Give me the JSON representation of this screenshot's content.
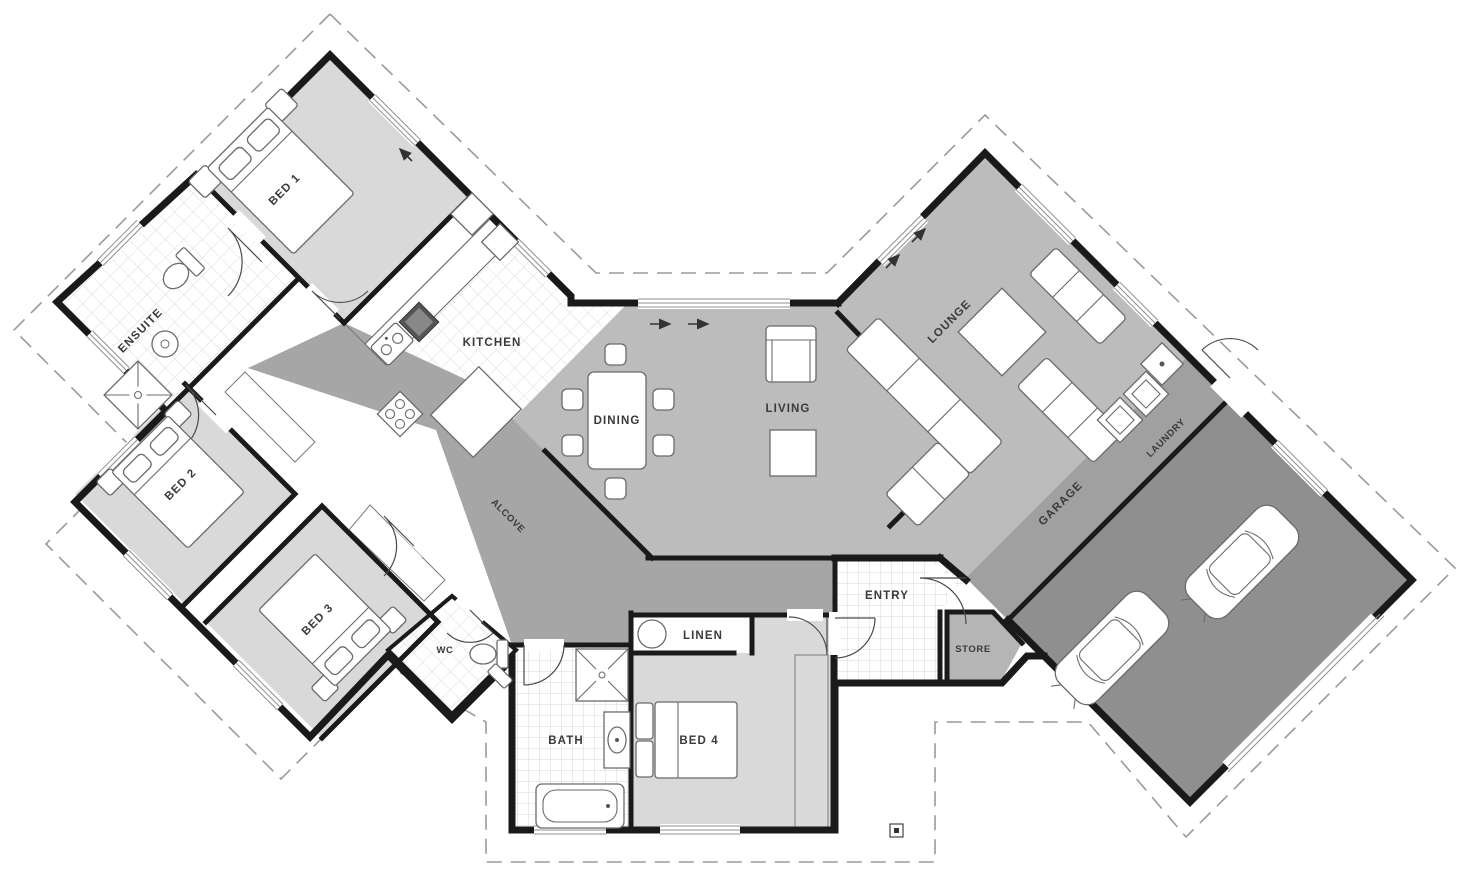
{
  "plan": {
    "rooms": {
      "bed1": {
        "label": "BED 1"
      },
      "ensuite": {
        "label": "ENSUITE"
      },
      "bed2": {
        "label": "BED 2"
      },
      "bed3": {
        "label": "BED 3"
      },
      "wc": {
        "label": "WC"
      },
      "kitchen": {
        "label": "KITCHEN"
      },
      "alcove": {
        "label": "ALCOVE"
      },
      "dining": {
        "label": "DINING"
      },
      "living": {
        "label": "LIVING"
      },
      "lounge": {
        "label": "LOUNGE"
      },
      "laundry": {
        "label": "LAUNDRY"
      },
      "garage": {
        "label": "GARAGE"
      },
      "entry": {
        "label": "ENTRY"
      },
      "store": {
        "label": "STORE"
      },
      "bath": {
        "label": "BATH"
      },
      "bed4": {
        "label": "BED 4"
      },
      "linen": {
        "label": "LINEN"
      }
    },
    "colors": {
      "wall": "#1a1a1a",
      "bedroom_floor": "#d9d9d9",
      "open_floor": "#bcbcbc",
      "hall_floor": "#a6a6a6",
      "laundry_floor": "#a0a0a0",
      "garage_floor": "#8f8f8f",
      "store_floor": "#b5b5b5",
      "boundary_dash": "#9a9a9a"
    }
  }
}
